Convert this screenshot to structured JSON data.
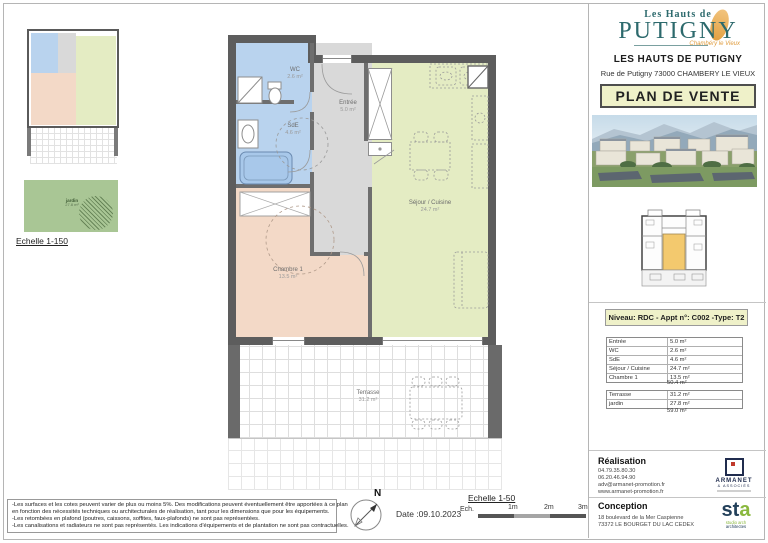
{
  "header": {
    "logo_top": "Les Hauts de",
    "logo_main": "PUTIGNY",
    "logo_sub": "Chambéry le Vieux",
    "project_name": "LES HAUTS DE PUTIGNY",
    "address": "Rue de Putigny 73000 CHAMBERY LE VIEUX",
    "doc_type": "PLAN DE VENTE"
  },
  "apartment": {
    "info_title": "Niveau: RDC - Appt n°: C002 -Type: T2",
    "rooms": [
      {
        "name": "Entrée",
        "area": "5.0 m²"
      },
      {
        "name": "WC",
        "area": "2.6 m²"
      },
      {
        "name": "SdE",
        "area": "4.6 m²"
      },
      {
        "name": "Séjour / Cuisine",
        "area": "24.7 m²"
      },
      {
        "name": "Chambre 1",
        "area": "13.5 m²"
      }
    ],
    "rooms_total": "50.4 m²",
    "outdoor": [
      {
        "name": "Terrasse",
        "area": "31.2 m²"
      },
      {
        "name": "jardin",
        "area": "27.8 m²"
      }
    ],
    "outdoor_total": "59.0 m²"
  },
  "plan": {
    "labels": {
      "wc": {
        "name": "WC",
        "area": "2.6 m²"
      },
      "sde": {
        "name": "SdE",
        "area": "4.6 m²"
      },
      "entree": {
        "name": "Entrée",
        "area": "5.0 m²"
      },
      "sejour": {
        "name": "Séjour / Cuisine",
        "area": "24.7 m²"
      },
      "chambre": {
        "name": "Chambre 1",
        "area": "13.5 m²"
      },
      "terrasse": {
        "name": "Terrasse",
        "area": "31.2 m²"
      },
      "jardin": {
        "name": "jardin",
        "area": "27.8 m²"
      }
    },
    "scale_small": "Echelle 1-150"
  },
  "realisation": {
    "title": "Réalisation",
    "phone1": "04.79.35.80.30",
    "phone2": "06.20.46.94.90",
    "email": "adv@armanet-promotion.fr",
    "web": "www.armanet-promotion.fr",
    "logo_name": "ARMANET",
    "logo_sub": "& ASSOCIÉS"
  },
  "conception": {
    "title": "Conception",
    "addr1": "18 boulevard de la Mer Caspienne",
    "addr2": "73372 LE BOURGET DU LAC CEDEX",
    "logo_st": "st",
    "logo_a": "a",
    "logo_sub1": "studio arch",
    "logo_sub2": "architectes"
  },
  "footer": {
    "disclaimers": [
      "-Les surfaces et les cotes peuvent varier de plus ou moins 5%. Des modifications peuvent éventuellement être apportées à ce plan",
      "en fonction des nécessités techniques ou architecturales de réalisation, tant pour les dimensions que pour les équipements.",
      "-Les retombées en plafond (poutres, caissons, soffites, faux-plafonds) ne sont pas représentées.",
      "-Les canalisations et radiateurs ne sont pas représentés. Les indications d'équipements et de plantation ne sont pas contractuelles."
    ],
    "compass_label": "N",
    "date": "Date :09.10.2023",
    "scale_title": "Echelle 1-50",
    "scale_prefix": "Ech.",
    "scale_m1": "1m",
    "scale_m2": "2m",
    "scale_m3": "3m"
  },
  "colors": {
    "brand_teal": "#2d6a6d",
    "brand_orange": "#e2a041",
    "box_bg": "#eff1c9",
    "room_blue": "#b9d3ee",
    "room_gray": "#d9d9d9",
    "room_green": "#e4ecc3",
    "room_salmon": "#f3d9c7",
    "wall_dark": "#5d5d5d",
    "jardin_green": "#a9c695",
    "unit_highlight": "#f3c96e"
  }
}
